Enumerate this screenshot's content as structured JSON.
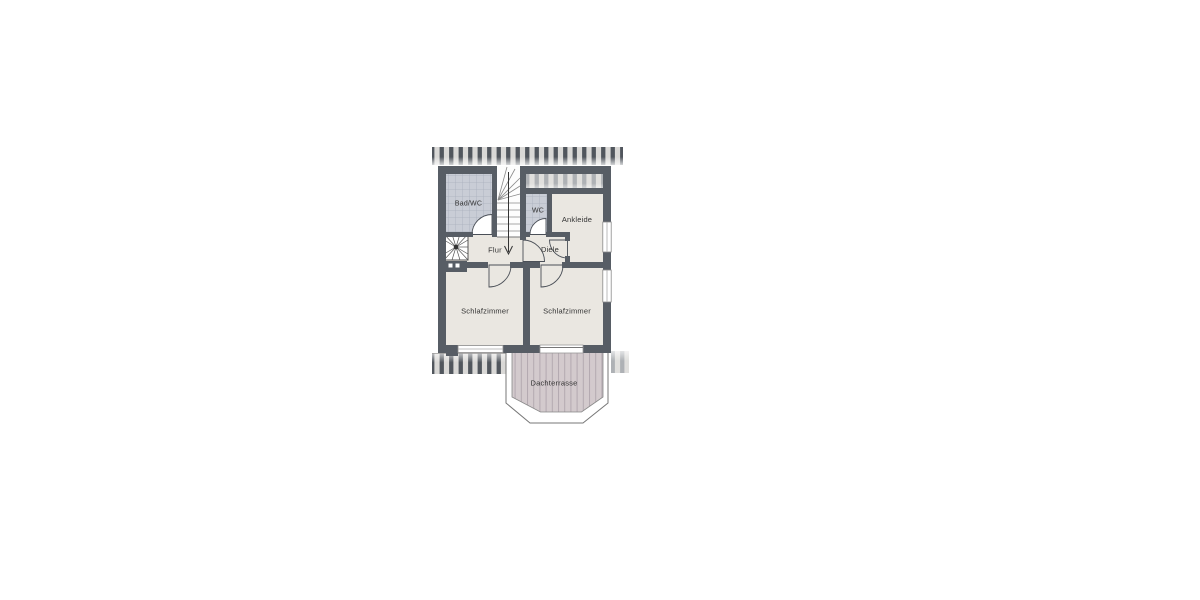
{
  "floorplan": {
    "floor_type": "attic floor plan",
    "rooms": [
      {
        "id": "bad-wc",
        "label": "Bad/WC"
      },
      {
        "id": "wc",
        "label": "WC"
      },
      {
        "id": "ankleide",
        "label": "Ankleide"
      },
      {
        "id": "flur",
        "label": "Flur"
      },
      {
        "id": "diele",
        "label": "Diele"
      },
      {
        "id": "schlafzimmer-links",
        "label": "Schlafzimmer"
      },
      {
        "id": "schlafzimmer-rechts",
        "label": "Schlafzimmer"
      },
      {
        "id": "dachterrasse",
        "label": "Dachterrasse"
      }
    ],
    "icons": [
      "staircase-icon",
      "stair-direction-arrow-icon",
      "spiral-staircase-icon",
      "chimney-icon",
      "door-swing-icon",
      "window-icon",
      "roof-hatch-icon",
      "terrace-decking-icon"
    ],
    "colors": {
      "wall": "#575d65",
      "floor": "#eae7e1",
      "tiles": "#c9cdd6",
      "tile_grid": "#a9afbc",
      "terrace_deck": "#d3cacd",
      "terrace_plank_line": "#b3a9b0",
      "roof_hatch_bar": "#51565d",
      "roof_hatch_bg": "#d9d8d6",
      "background": "#ffffff"
    }
  }
}
